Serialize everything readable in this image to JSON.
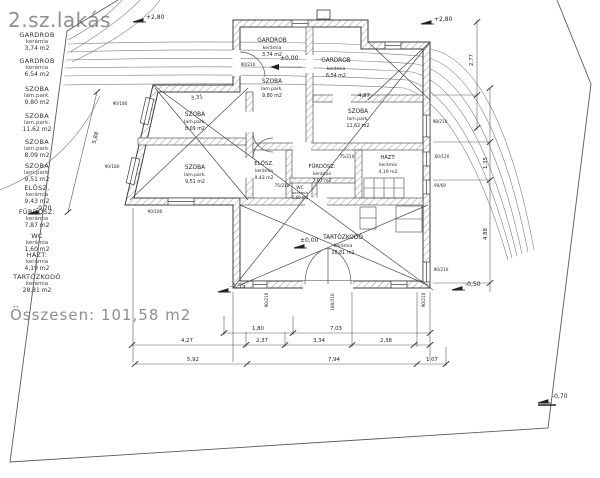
{
  "title": "2.sz.lakás",
  "legend": {
    "items": [
      {
        "name": "GARDROB",
        "material": "kerámia",
        "area": "3,74  m2"
      },
      {
        "name": "GARDROB",
        "material": "kerámia",
        "area": "6,54  m2"
      },
      {
        "name": "SZOBA",
        "material": "lam.park.",
        "area": "9,80  m2"
      },
      {
        "name": "SZOBA",
        "material": "lam.park.",
        "area": "11,62  m2"
      },
      {
        "name": "SZOBA",
        "material": "lam.park.",
        "area": "8,09  m2"
      },
      {
        "name": "SZOBA",
        "material": "lam.park.",
        "area": "9,51  m2"
      },
      {
        "name": "ELŐSZ.",
        "material": "kerámia",
        "area": "9,43  m2"
      },
      {
        "name": "FÜRDŐSZ:",
        "material": "kerámia",
        "area": "7,87  m2"
      },
      {
        "name": "WC",
        "material": "kerámia",
        "area": "1,60  m2"
      },
      {
        "name": "HÁZT:",
        "material": "kerámia",
        "area": "4,19  m2"
      },
      {
        "name": "TARTÓZKODÓ",
        "material": "kerámia",
        "area": "28,81  m2"
      }
    ],
    "total": "Összesen:  101,58 m2"
  },
  "levels": {
    "plus280_left": "+2,80",
    "plus280_right": "+2,80",
    "zero_entry": "±0,00",
    "zero_living": "±0,00",
    "minus070_left": "-0,70",
    "minus055_terrace": "-0,55",
    "minus050_right": "-0,50",
    "minus070_bottom": "-0,70"
  },
  "dims": {
    "slant": "5,88",
    "top_room": "3,31",
    "szoba": "4,87",
    "b180": "1,80",
    "b703": "7,03",
    "b427": "4,27",
    "b237": "2,37",
    "b334": "3,34",
    "b238": "2,38",
    "b592": "5,92",
    "b794": "7,94",
    "b107": "1,07",
    "r277": "2,77",
    "r135": "1,35",
    "r488": "4,88"
  },
  "window_dims": {
    "w1": "90/180",
    "w2": "90/180",
    "w3": "90/180",
    "w4": "98/210",
    "w5": "60/120",
    "w6": "90/60",
    "w7": "90/210",
    "w8": "75/210",
    "w9": "75/210",
    "w10": "90/210",
    "w11": "180/210",
    "w12": "90/210",
    "w13": "90/210"
  },
  "colors": {
    "ink": "#1f1f1f",
    "line": "#444444",
    "muted": "#8e8e8e",
    "hatch": "#9a9a9a"
  }
}
